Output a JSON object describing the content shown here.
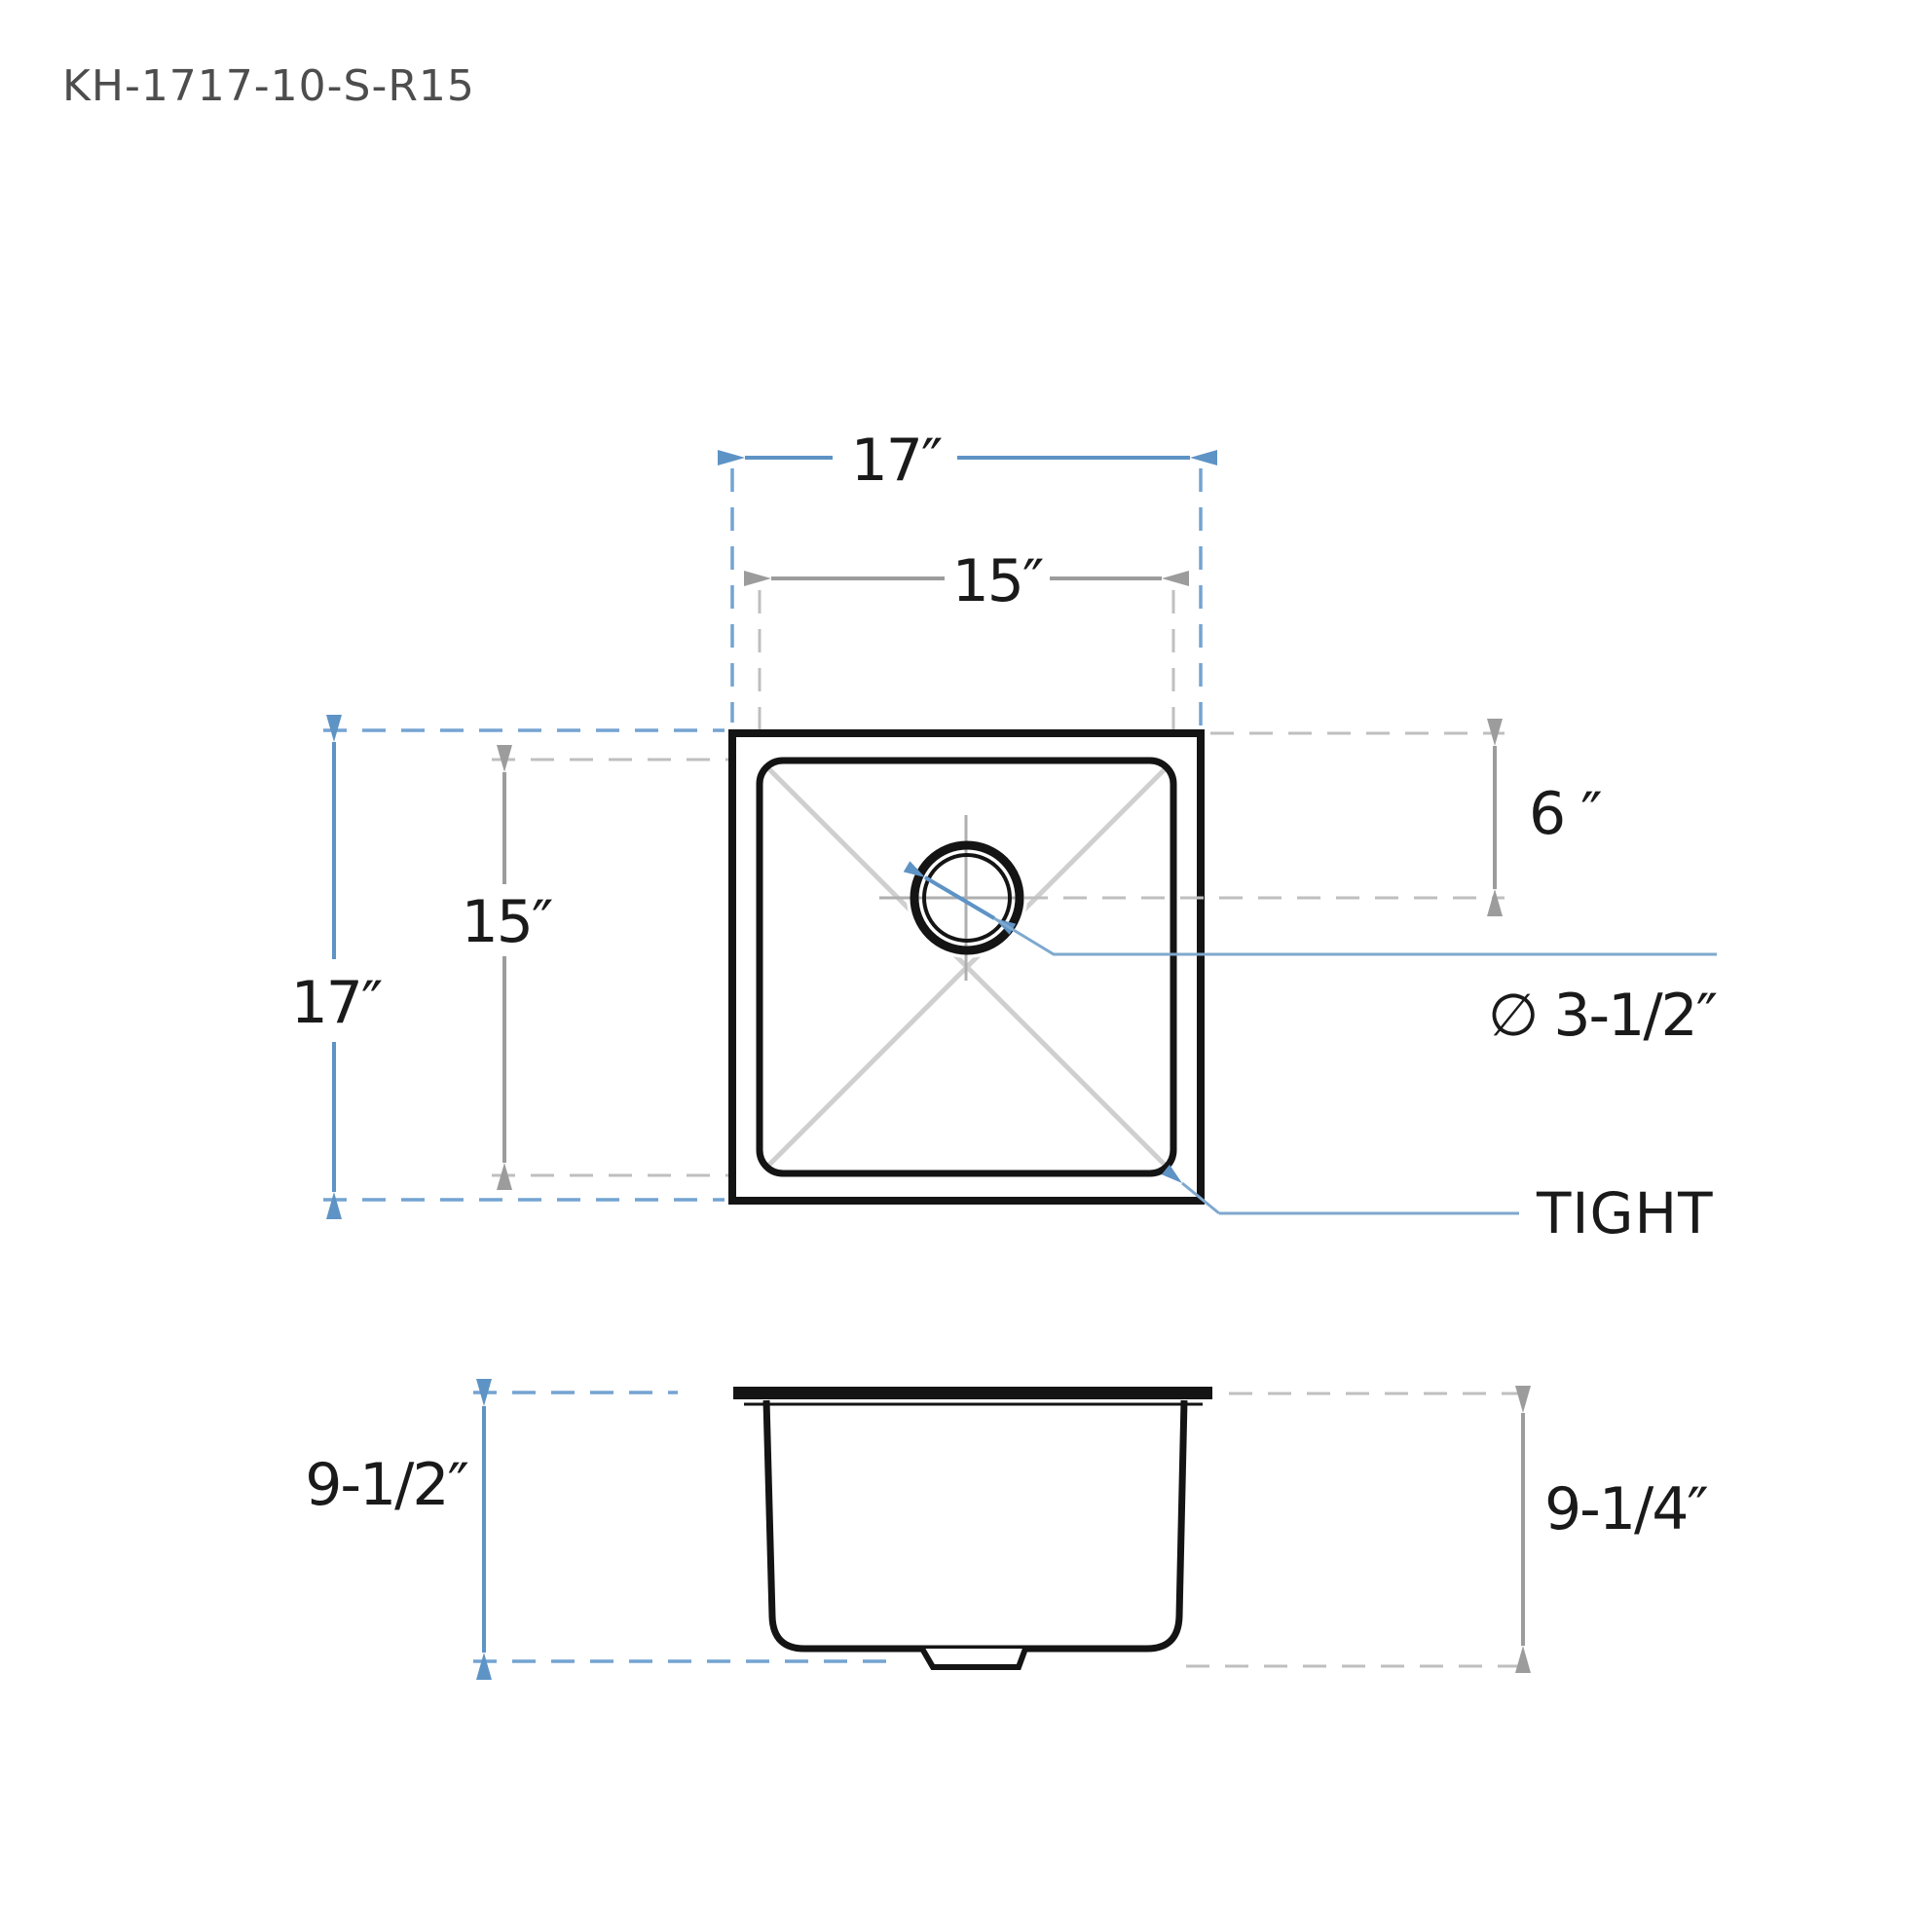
{
  "title": "KH-1717-10-S-R15",
  "colors": {
    "drawing_line": "#141414",
    "dim_blue": "#5E93C5",
    "dim_blue_dash": "#74A4D2",
    "leader_blue": "#7FA8CE",
    "dim_gray": "#9C9C9C",
    "dim_gray_dash": "#BFBFBF",
    "corner_x_lines": "#CFCFCF",
    "crosshair_gray": "#AFAFAF",
    "label_text": "#1A1A1A",
    "title_text": "#4D4D4D"
  },
  "top_view": {
    "outer_width_label": "17″",
    "inner_width_label": "15″",
    "outer_height_label": "17″",
    "inner_height_label": "15″",
    "drain_offset_label": "6 ″",
    "drain_diameter_label": "∅ 3-1/2″",
    "corner_radius_label": "TIGHT"
  },
  "side_view": {
    "overall_depth_label": "9-1/2″",
    "bowl_depth_label": "9-1/4″"
  }
}
